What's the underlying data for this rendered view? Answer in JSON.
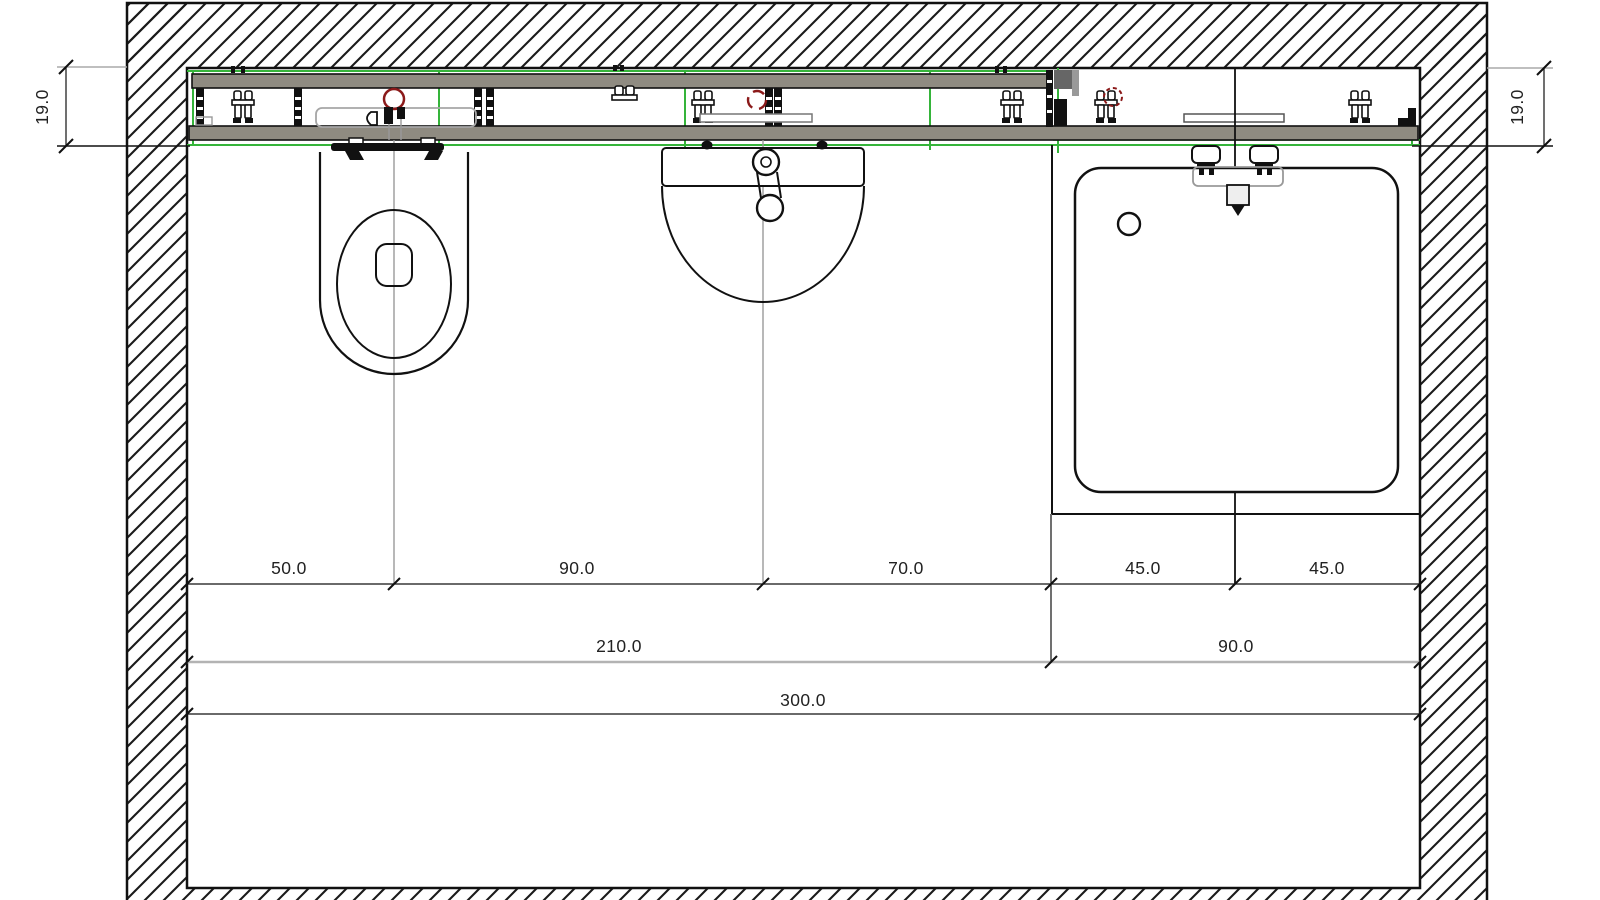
{
  "drawing": {
    "type": "bathroom-prewall-installation-plan",
    "view": "top-view floor plan with sanitary fixtures and mounting rail"
  },
  "colors": {
    "line": "#1a1a1a",
    "rail_fill": "#8f8b81",
    "guide_green": "#35b43a",
    "valve_red": "#8b1a1a",
    "extension_gray": "#999999",
    "group_dim_line": "#b3b3b3",
    "background": "#ffffff"
  },
  "dimensions": {
    "segments_row": [
      "50.0",
      "90.0",
      "70.0",
      "45.0",
      "45.0"
    ],
    "group_row": [
      "210.0",
      "90.0"
    ],
    "total_row": "300.0",
    "rail_depth_left": "19.0",
    "rail_depth_right": "19.0"
  }
}
